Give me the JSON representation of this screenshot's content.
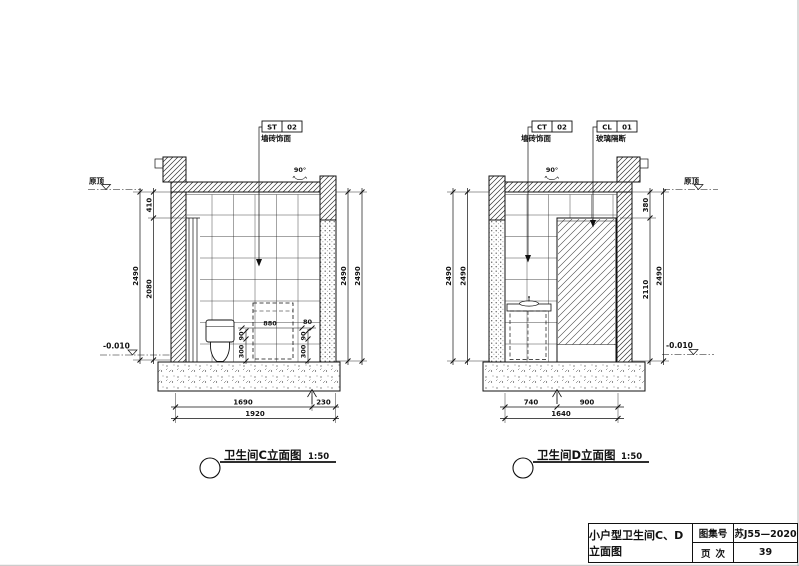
{
  "elevation_c": {
    "title": "卫生间C立面图",
    "scale": "1:50",
    "tag": {
      "code": "ST",
      "num": "02",
      "desc": "墙砖饰面"
    },
    "angle_note": "90°",
    "level_top": "原顶",
    "level_bottom": "-0.010",
    "dims": {
      "left_chain_top": "410",
      "left_chain_bottom": "2080",
      "left_overall": "2490",
      "right_inner": "2490",
      "right_outer": "2490",
      "bottom_left": "1690",
      "bottom_right": "230",
      "bottom_overall": "1920",
      "inner_width": "880",
      "inner_gap": "80",
      "inner_left_small": "90",
      "inner_left_large": "300",
      "inner_right_small": "90",
      "inner_right_large": "300"
    }
  },
  "elevation_d": {
    "title": "卫生间D立面图",
    "scale": "1:50",
    "tag_wall": {
      "code": "CT",
      "num": "02",
      "desc": "墙砖饰面"
    },
    "tag_glass": {
      "code": "CL",
      "num": "01",
      "desc": "玻璃隔断"
    },
    "angle_note": "90°",
    "level_top": "原顶",
    "level_bottom": "-0.010",
    "dims": {
      "left_inner": "2490",
      "left_outer": "2490",
      "right_chain_top": "380",
      "right_chain_bottom": "2110",
      "right_overall": "2490",
      "bottom_left": "740",
      "bottom_right": "900",
      "bottom_overall": "1640"
    }
  },
  "title_block": {
    "drawing_title": "小户型卫生间C、D立面图",
    "atlas_label": "图集号",
    "atlas_value": "苏J55—2020",
    "page_label": "页次",
    "page_value": "39"
  }
}
